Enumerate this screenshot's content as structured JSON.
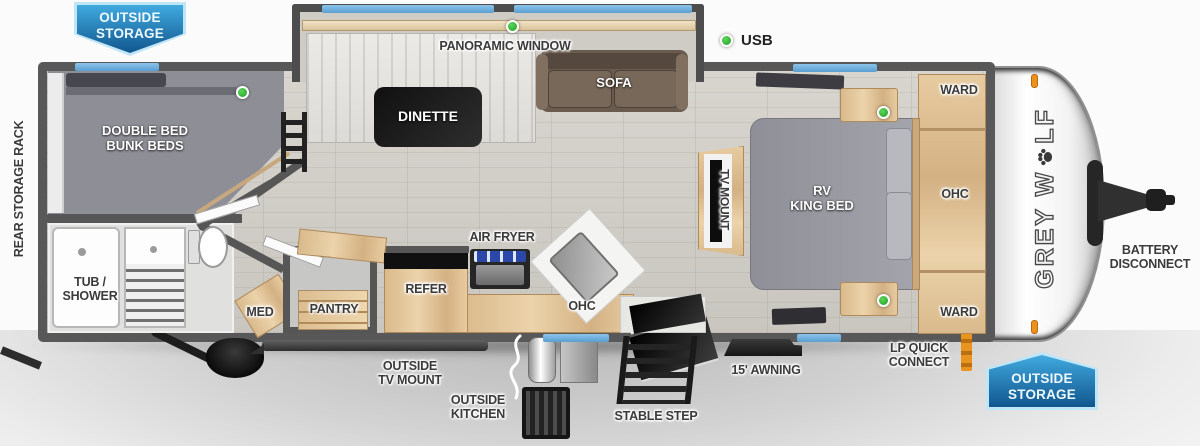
{
  "legend": {
    "usb_label": "USB"
  },
  "banners": {
    "outside_storage_top": {
      "line1": "OUTSIDE",
      "line2": "STORAGE"
    },
    "outside_storage_bottom": {
      "line1": "OUTSIDE",
      "line2": "STORAGE"
    }
  },
  "interior": {
    "bunk_room": {
      "line1": "DOUBLE BED",
      "line2": "BUNK BEDS"
    },
    "dinette": "DINETTE",
    "sofa": "SOFA",
    "panoramic_window": "PANORAMIC WINDOW",
    "tub_shower": {
      "line1": "TUB /",
      "line2": "SHOWER"
    },
    "med": "MED",
    "pantry": "PANTRY",
    "refer": "REFER",
    "air_fryer": "AIR FRYER",
    "ohc_kitchen": "OHC",
    "tv_mount": "TV MOUNT",
    "king_bed": {
      "line1": "RV",
      "line2": "KING BED"
    },
    "ward_front": "WARD",
    "ohc_bedroom": "OHC",
    "ward_rear": "WARD"
  },
  "exterior": {
    "rear_storage_rack": "REAR STORAGE RACK",
    "outside_tv_mount": {
      "line1": "OUTSIDE",
      "line2": "TV MOUNT"
    },
    "outside_kitchen": {
      "line1": "OUTSIDE",
      "line2": "KITCHEN"
    },
    "stable_step": "STABLE STEP",
    "awning": "15' AWNING",
    "lp_quick_connect": {
      "line1": "LP QUICK",
      "line2": "CONNECT"
    },
    "battery_disconnect": {
      "line1": "BATTERY",
      "line2": "DISCONNECT"
    }
  },
  "brand": {
    "name": "GREY WOLF",
    "logo_part1": "GREY W",
    "logo_part2": "LF"
  },
  "colors": {
    "window_accent_blue": "#6fb1de",
    "usb_indicator_green": "#2eb82e",
    "banner_blue_light": "#3ba6dd",
    "banner_blue_dark": "#0f4f84",
    "wall_gray": "#565656",
    "cabinet_wood": "#e0c49c"
  }
}
